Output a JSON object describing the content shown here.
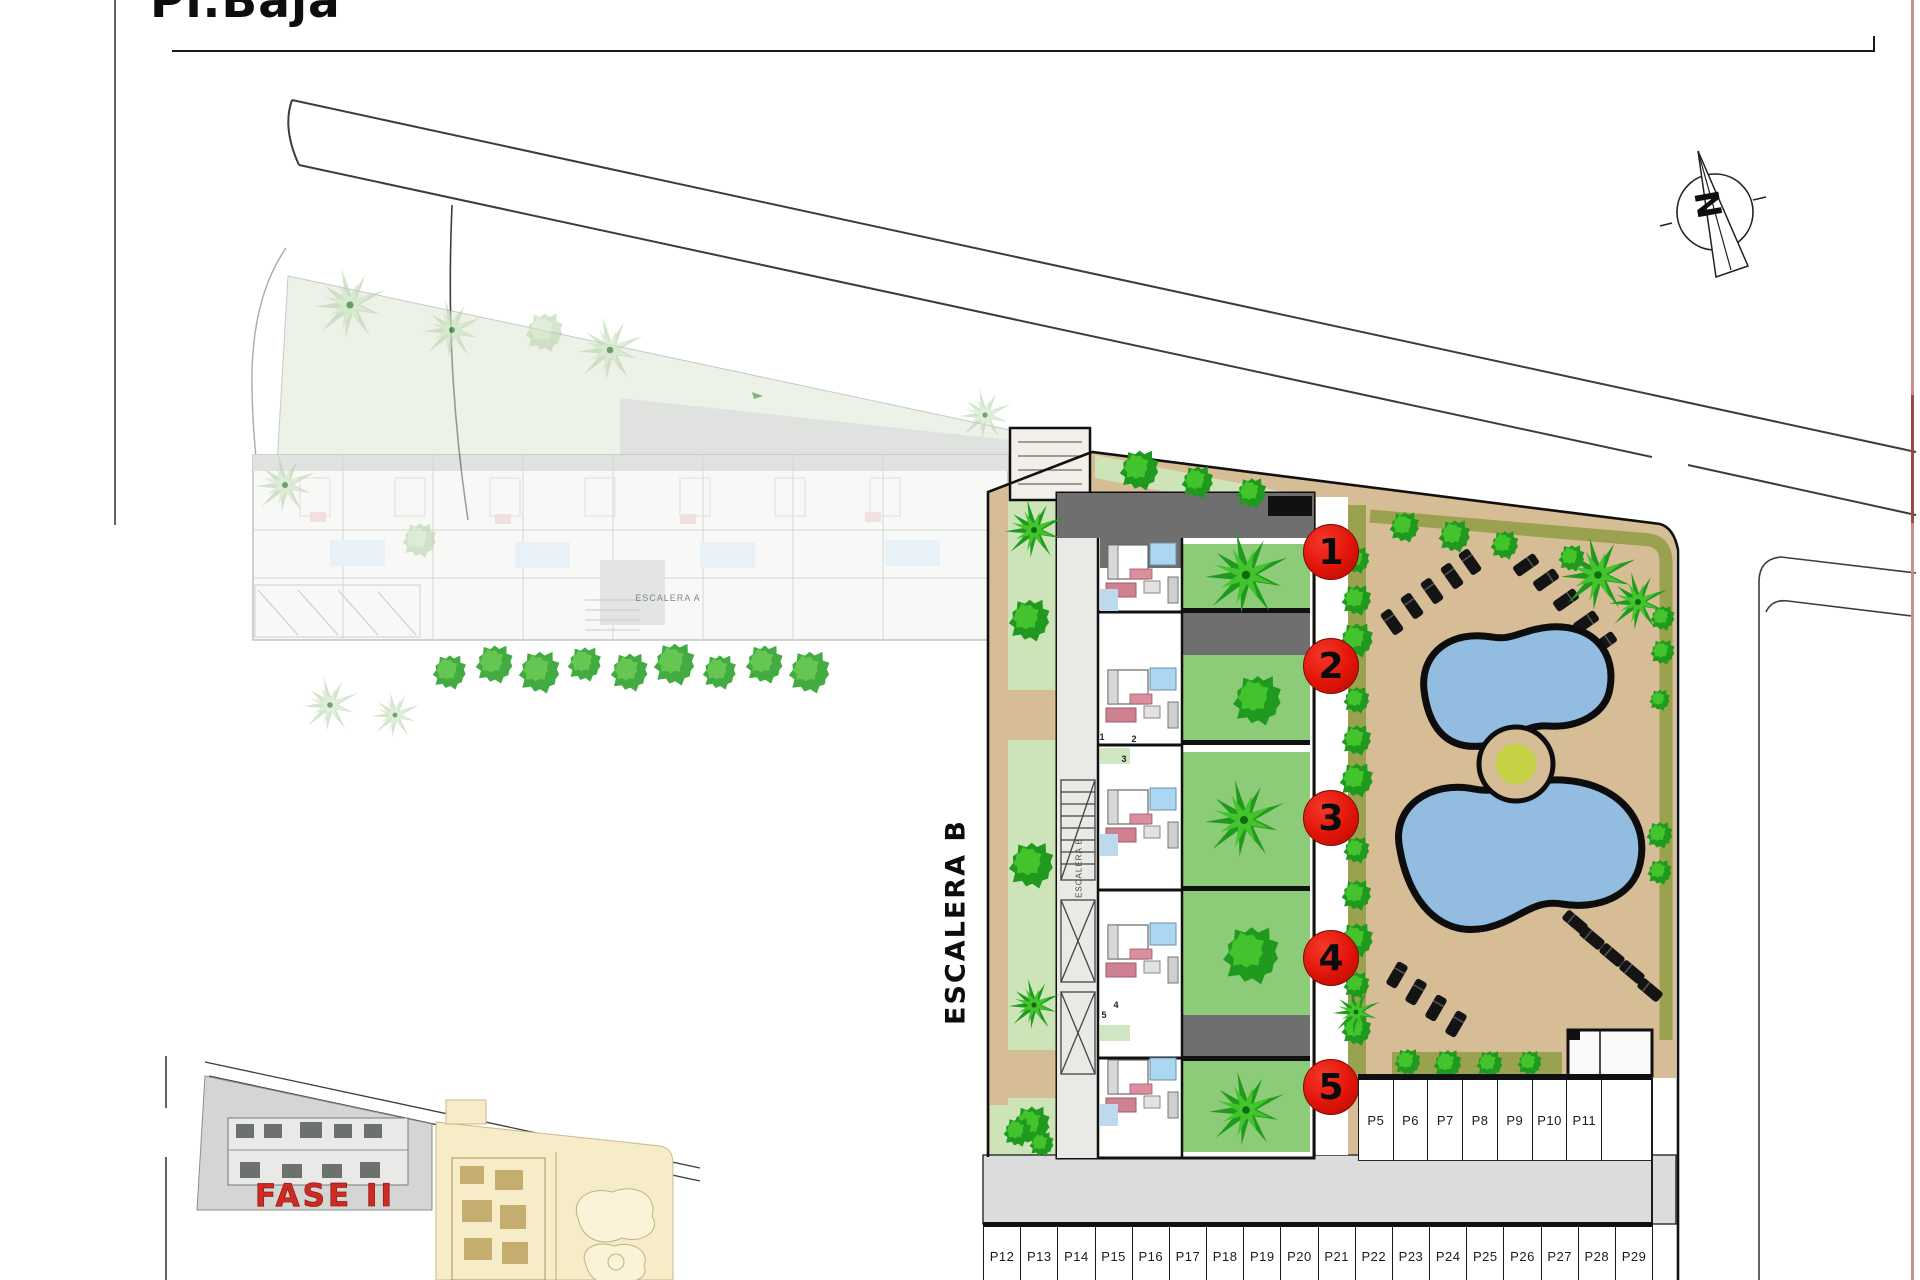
{
  "page": {
    "title": "Pl.Baja"
  },
  "north_indicator": {
    "letter": "N"
  },
  "site": {
    "building_label_large": "ESCALERA B",
    "building_label_small": "ESCALERA B",
    "faded_building_label": "ESCALERA A",
    "phase_label": "FASE II",
    "unit_badges": [
      "1",
      "2",
      "3",
      "4",
      "5"
    ],
    "unit_door_numbers": [
      "1",
      "2",
      "3",
      "4",
      "5"
    ]
  },
  "parking": {
    "row_upper": {
      "labels": [
        "P5",
        "P6",
        "P7",
        "P8",
        "P9",
        "P10",
        "P11"
      ]
    },
    "row_lower": {
      "labels": [
        "P12",
        "P13",
        "P14",
        "P15",
        "P16",
        "P17",
        "P18",
        "P19",
        "P20",
        "P21",
        "P22",
        "P23",
        "P24",
        "P25",
        "P26",
        "P27",
        "P28",
        "P29"
      ]
    }
  },
  "colors": {
    "accent_red": "#e01408",
    "phase_red": "#cf2b24",
    "tan": "#d7bd96",
    "olive": "#9aa24f",
    "lawn": "#cde3b8",
    "patio_green": "#8ccb77",
    "tree_dark": "#1f9a1f",
    "tree_light": "#43c32c",
    "pool_blue": "#92bce0",
    "bath_blue": "#abd7f3",
    "sofa_pink": "#cf8191",
    "road_gray": "#dcdcdc",
    "wall_black": "#111111",
    "roof_gray": "#6f6f6f",
    "faded_gray": "#d2d5d1",
    "cream": "#f7ecc8"
  }
}
